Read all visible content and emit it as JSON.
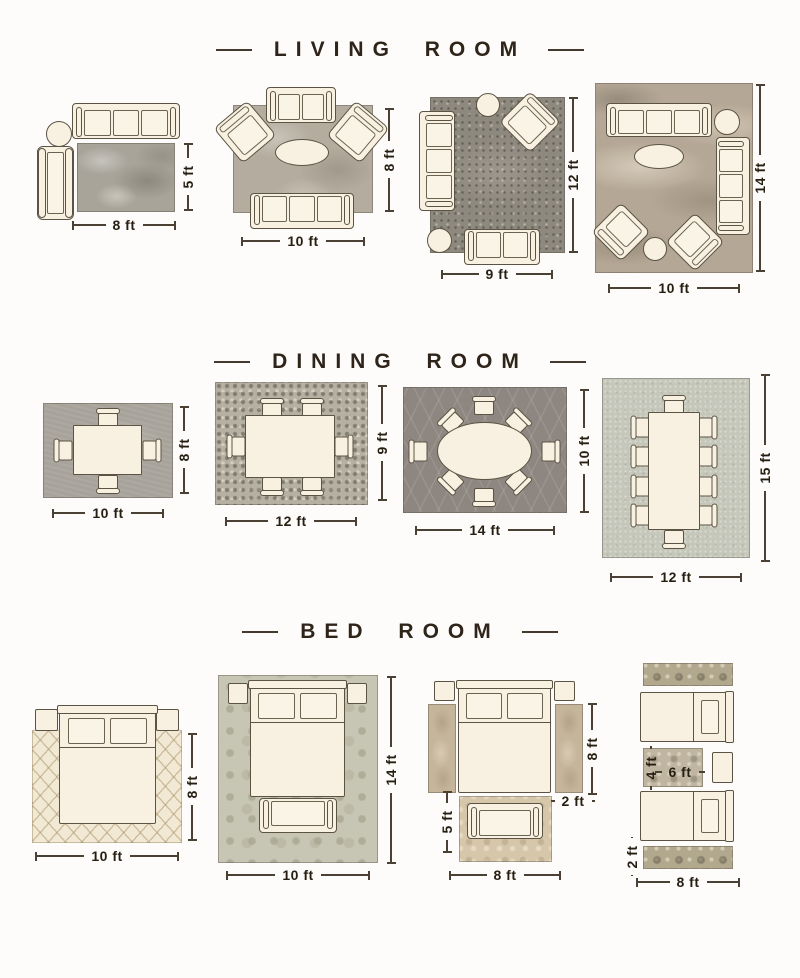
{
  "titles": {
    "living": "LIVING ROOM",
    "dining": "DINING ROOM",
    "bedroom": "BED ROOM"
  },
  "living": {
    "l1": {
      "w": "8 ft",
      "h": "5 ft"
    },
    "l2": {
      "w": "10 ft",
      "h": "8 ft"
    },
    "l3": {
      "w": "9 ft",
      "h": "12 ft"
    },
    "l4": {
      "w": "10 ft",
      "h": "14 ft"
    }
  },
  "dining": {
    "d1": {
      "w": "10 ft",
      "h": "8 ft"
    },
    "d2": {
      "w": "12 ft",
      "h": "9 ft"
    },
    "d3": {
      "w": "14 ft",
      "h": "10 ft"
    },
    "d4": {
      "w": "12 ft",
      "h": "15 ft"
    }
  },
  "bedroom": {
    "b1": {
      "w": "10 ft",
      "h": "8 ft"
    },
    "b2": {
      "w": "10 ft",
      "h": "14 ft"
    },
    "b3": {
      "runner_h": "8 ft",
      "runner_w": "2 ft",
      "foot_h": "5 ft",
      "foot_w": "8 ft"
    },
    "b4": {
      "mid_h": "4 ft",
      "mid_w": "6 ft",
      "runner_w": "2 ft",
      "runner_l": "8 ft"
    }
  },
  "colors": {
    "page_bg": "#fdfcfa",
    "title_text": "#2e241a",
    "dim_text": "#271e12",
    "dim_line": "#4a4033",
    "furniture_fill": "#f8f1e2",
    "furniture_outline": "#5b5343",
    "rug_gray_mottle": "#a8a49a",
    "rug_gray_light": "#b4ac9e",
    "rug_gray_distressed": "#8e897f",
    "rug_abstract_tan": "#b5a795",
    "rug_dining_gray": "#a7a39b",
    "rug_mosaic": "#b6b0a2",
    "rug_dark_lattice": "#8d8681",
    "rug_sage": "#c6c7bb",
    "rug_cream_trellis": "#f2e9d4",
    "rug_damask_sage": "#c7c6b4",
    "rug_runner_tan": "#c5b59b",
    "rug_floral_tan": "#d6c7ab",
    "rug_ornate": "#b2a88e"
  }
}
